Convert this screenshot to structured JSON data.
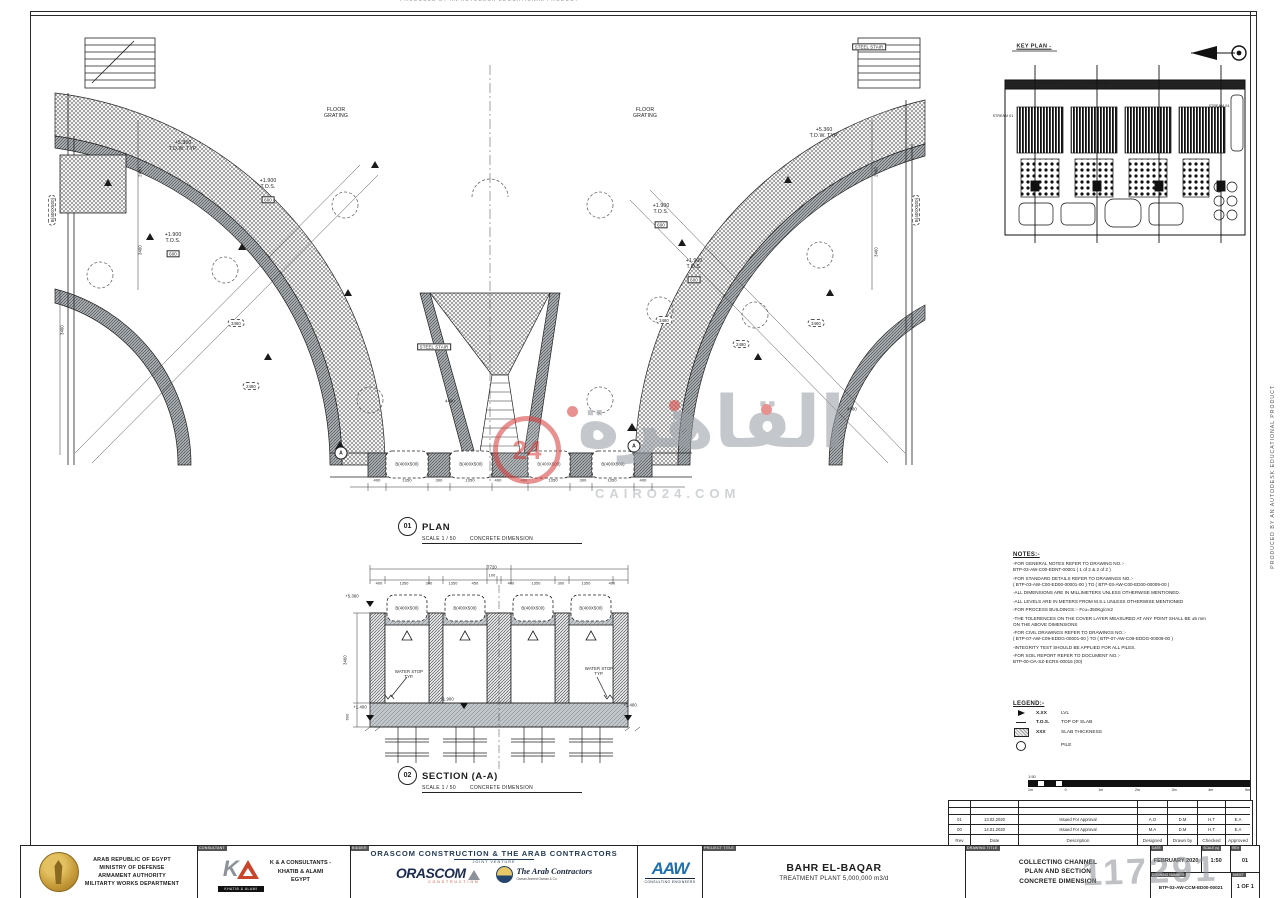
{
  "watermark": {
    "arabic": "القاهرة",
    "number": "24",
    "site": "CAIRO24.COM",
    "id": "117291"
  },
  "edge": {
    "produced": "PRODUCED BY AN AUTODESK EDUCATIONAL PRODUCT"
  },
  "plan_title": {
    "num": "01",
    "title": "PLAN",
    "scale": "SCALE 1 / 50",
    "note": "CONCRETE DIMENSION"
  },
  "section_title": {
    "num": "02",
    "title": "SECTION (A-A)",
    "scale": "SCALE 1 / 50",
    "note": "CONCRETE DIMENSION"
  },
  "notes": {
    "title": "NOTES:-",
    "items": [
      "-FOR GENERAL NOTES REFER TO DRAWING NO.:-\nBTP-03-AW-C00-EDNT-00001 ( 1 of 2 & 2 of 2 )",
      "-FOR STANDARD DETAILS REFER TO DRAWINGS NO.:-\n( BTP-03-AW-C00-ED00-00001-00 ) TO ( BTP-03-AW-C00-ED00-00009-00 )",
      "-ALL DIMENSIONS ARE IN MILLIMETERS UNLESS OTHERWISE MENTIONED.",
      "-ALL LEVELS ARE IN METERS FROM M.S.L UNLESS OTHERWISE MENTIONED",
      "-FOR PROCESS BUILDINGS :- Fcu=350Kg/cm2",
      "-THE TOLERENCES ON THE COVER LAYER MEASURED AT ANY POINT SHALL BE ±5 mm\nON THE ABOVE DIMENSIONS",
      "-FOR CIVIL DRAWINGS REFER TO DRAWINGS NO.:-\n( BTP-07-AW-C09-EDDG-00001-00 ) TO ( BTP-07-AW-C09-EDDG-00009-00 )",
      "-INTEGRITY TEST SHOULD BE APPLIED FOR ALL PILES.",
      "-FOR SOIL REPORT REFER TO DOCUMENT NO.:-\nBTP-00-OA-SZ-ECRS-00016 (00)"
    ]
  },
  "legend": {
    "title": "LEGEND:-",
    "items": [
      {
        "sym": "lvl",
        "val": "X.XX",
        "label": "LVL"
      },
      {
        "sym": "tos",
        "val": "T.O.S.",
        "label": "TOP OF SLAB"
      },
      {
        "sym": "thk",
        "val": "XXX",
        "label": "SLAB THICKNESS"
      },
      {
        "sym": "pile",
        "val": "",
        "label": "PILE"
      }
    ]
  },
  "scale_bar": {
    "ratio": "1:50",
    "ticks": [
      "1m",
      "0",
      "1m",
      "2m",
      "3m",
      "4m",
      "5m"
    ]
  },
  "revision_table": {
    "headers": [
      "Rev",
      "Date",
      "Description",
      "Designed",
      "Drawn by",
      "Checked",
      "Approved"
    ],
    "rows": [
      [
        "01",
        "13.02.2020",
        "Issued For Approval",
        "A.O",
        "D.M",
        "H.T",
        "E.A"
      ],
      [
        "00",
        "14.01.2020",
        "Issued For Approval",
        "M.A",
        "D.M",
        "H.T",
        "E.A"
      ]
    ]
  },
  "title_block": {
    "owner": {
      "lines": [
        "ARAB REPUBLIC OF EGYPT",
        "MINISTRY OF DEFENSE",
        "ARMAMENT AUTHORITY",
        "MILITARTY WORKS DEPARTMENT"
      ]
    },
    "consultant": {
      "label": "CONSULTANT",
      "logo_text": "KHATIB & ALAMI",
      "lines": [
        "K & A CONSULTANTS -",
        "KHATIB & ALAMI",
        "EGYPT"
      ]
    },
    "bidder": {
      "label": "BIDDER",
      "jv_title": "ORASCOM CONSTRUCTION & THE ARAB CONTRACTORS",
      "jv_sub": "JOINT VENTURE",
      "orascom": "ORASCOM",
      "orascom_sub": "CONSTRUCTION",
      "arab": "The Arab Contractors",
      "arab_sub": "Osman Ahmed Osman & Co.",
      "aaw": "AAW",
      "aaw_sub": "CONSULTING ENGINEERS"
    },
    "project": {
      "label": "PROJECT TITLE",
      "line1": "BAHR EL-BAQAR",
      "line2": "TREATMENT PLANT 5,000,000 m3/d"
    },
    "drawing": {
      "label": "DRAWING TITLE",
      "lines": [
        "COLLECTING CHANNEL",
        "PLAN AND SECTION",
        "CONCRETE DIMENSION"
      ]
    },
    "meta": {
      "date_label": "DATE",
      "date": "FEBRUARY 2020",
      "scale_label": "SCALE (s)",
      "scale": "1:50",
      "rev_label": "REV",
      "rev": "01",
      "num_label": "DRAWING NUMBER",
      "number": "BTP-03-AW-CCM-ED00-00021",
      "sheet_label": "SHEET",
      "sheet": "1 OF 1"
    }
  },
  "labels": [
    {
      "t": "FLOOR\nGRATING",
      "x": 336,
      "y": 113,
      "n": "floor-grating-label"
    },
    {
      "t": "FLOOR\nGRATING",
      "x": 645,
      "y": 113,
      "n": "floor-grating-label"
    },
    {
      "t": "+5.360\nT.O.W. TYP.",
      "x": 183,
      "y": 146,
      "n": "level-label"
    },
    {
      "t": "+5.360\nT.O.W. TYP.",
      "x": 824,
      "y": 133,
      "n": "level-label"
    },
    {
      "t": "+1.900\nT.O.S.",
      "x": 268,
      "y": 184,
      "n": "level-label"
    },
    {
      "t": "600",
      "x": 268,
      "y": 200,
      "cls": "box",
      "fs": 4.5,
      "n": "slab-thickness-label"
    },
    {
      "t": "+1.900\nT.O.S.",
      "x": 173,
      "y": 238,
      "n": "level-label"
    },
    {
      "t": "600",
      "x": 173,
      "y": 254,
      "cls": "box",
      "fs": 4.5,
      "n": "slab-thickness-label"
    },
    {
      "t": "+1.900\nT.O.S.",
      "x": 661,
      "y": 209,
      "n": "level-label"
    },
    {
      "t": "600",
      "x": 661,
      "y": 225,
      "cls": "box",
      "fs": 4.5,
      "n": "slab-thickness-label"
    },
    {
      "t": "+1.900\nT.O.S.",
      "x": 694,
      "y": 264,
      "n": "level-label"
    },
    {
      "t": "600",
      "x": 694,
      "y": 280,
      "cls": "box",
      "fs": 4.5,
      "n": "slab-thickness-label"
    },
    {
      "t": "B(400X500)",
      "x": 52,
      "y": 210,
      "rot": -90,
      "fs": 4.4,
      "cls": "cloud",
      "n": "beam-label"
    },
    {
      "t": "B(400X500)",
      "x": 916,
      "y": 210,
      "rot": -90,
      "fs": 4.4,
      "cls": "cloud",
      "n": "beam-label"
    },
    {
      "t": "STEEL STAIR",
      "x": 869,
      "y": 47,
      "cls": "box",
      "fs": 4.4,
      "n": "steel-stair-label"
    },
    {
      "t": "STEEL STAIR",
      "x": 434,
      "y": 347,
      "cls": "box",
      "fs": 4.4,
      "n": "steel-stair-label"
    },
    {
      "t": "B(400X500)",
      "x": 407,
      "y": 464,
      "fs": 4.2,
      "n": "beam-label"
    },
    {
      "t": "B(400X500)",
      "x": 471,
      "y": 464,
      "fs": 4.2,
      "n": "beam-label"
    },
    {
      "t": "B(400X500)",
      "x": 549,
      "y": 464,
      "fs": 4.2,
      "n": "beam-label"
    },
    {
      "t": "B(400X500)",
      "x": 613,
      "y": 464,
      "fs": 4.2,
      "n": "beam-label"
    },
    {
      "t": "400",
      "x": 377,
      "y": 481,
      "fs": 4,
      "n": "dimension"
    },
    {
      "t": "1350",
      "x": 407,
      "y": 481,
      "fs": 4,
      "n": "dimension"
    },
    {
      "t": "300",
      "x": 439,
      "y": 481,
      "fs": 4,
      "n": "dimension"
    },
    {
      "t": "1350",
      "x": 470,
      "y": 481,
      "fs": 4,
      "n": "dimension"
    },
    {
      "t": "400",
      "x": 498,
      "y": 481,
      "fs": 4,
      "n": "dimension"
    },
    {
      "t": "400",
      "x": 524,
      "y": 481,
      "fs": 4,
      "n": "dimension"
    },
    {
      "t": "1350",
      "x": 553,
      "y": 481,
      "fs": 4,
      "n": "dimension"
    },
    {
      "t": "300",
      "x": 583,
      "y": 481,
      "fs": 4,
      "n": "dimension"
    },
    {
      "t": "1350",
      "x": 612,
      "y": 481,
      "fs": 4,
      "n": "dimension"
    },
    {
      "t": "400",
      "x": 643,
      "y": 481,
      "fs": 4,
      "n": "dimension"
    },
    {
      "t": "2480",
      "x": 140,
      "y": 172,
      "rot": -90,
      "fs": 4.2,
      "n": "dimension"
    },
    {
      "t": "3460",
      "x": 140,
      "y": 250,
      "rot": -90,
      "fs": 4.2,
      "n": "dimension"
    },
    {
      "t": "3460",
      "x": 62,
      "y": 330,
      "rot": -90,
      "fs": 4.2,
      "n": "dimension"
    },
    {
      "t": "2480",
      "x": 876,
      "y": 172,
      "rot": -90,
      "fs": 4.2,
      "n": "dimension"
    },
    {
      "t": "3460",
      "x": 876,
      "y": 252,
      "rot": -90,
      "fs": 4.2,
      "n": "dimension"
    },
    {
      "t": "4480",
      "x": 450,
      "y": 401,
      "fs": 4.2,
      "n": "dimension"
    },
    {
      "t": "4480",
      "x": 852,
      "y": 409,
      "fs": 4.2,
      "n": "dimension"
    },
    {
      "t": "3460",
      "x": 236,
      "y": 323,
      "cls": "cloud",
      "fs": 4.2,
      "n": "dimension"
    },
    {
      "t": "2480",
      "x": 251,
      "y": 386,
      "cls": "cloud",
      "fs": 4.2,
      "n": "dimension"
    },
    {
      "t": "3460",
      "x": 664,
      "y": 320,
      "cls": "cloud",
      "fs": 4.2,
      "n": "dimension"
    },
    {
      "t": "3460",
      "x": 816,
      "y": 323,
      "cls": "cloud",
      "fs": 4.2,
      "n": "dimension"
    },
    {
      "t": "2480",
      "x": 741,
      "y": 344,
      "cls": "cloud",
      "fs": 4.2,
      "n": "dimension"
    },
    {
      "t": "A",
      "x": 341,
      "y": 453,
      "cls": "amark",
      "fs": 5,
      "n": "section-cut-marker"
    },
    {
      "t": "A",
      "x": 634,
      "y": 446,
      "cls": "amark",
      "fs": 5,
      "n": "section-cut-marker"
    },
    {
      "t": "7720",
      "x": 492,
      "y": 567,
      "fs": 4.2,
      "n": "dimension"
    },
    {
      "t": "100",
      "x": 492,
      "y": 576,
      "fs": 3.8,
      "n": "dimension"
    },
    {
      "t": "400",
      "x": 379,
      "y": 584,
      "fs": 3.8,
      "n": "dimension"
    },
    {
      "t": "1350",
      "x": 404,
      "y": 584,
      "fs": 3.8,
      "n": "dimension"
    },
    {
      "t": "300",
      "x": 429,
      "y": 584,
      "fs": 3.8,
      "n": "dimension"
    },
    {
      "t": "1350",
      "x": 453,
      "y": 584,
      "fs": 3.8,
      "n": "dimension"
    },
    {
      "t": "450",
      "x": 475,
      "y": 584,
      "fs": 3.8,
      "n": "dimension"
    },
    {
      "t": "400",
      "x": 511,
      "y": 584,
      "fs": 3.8,
      "n": "dimension"
    },
    {
      "t": "1350",
      "x": 536,
      "y": 584,
      "fs": 3.8,
      "n": "dimension"
    },
    {
      "t": "300",
      "x": 561,
      "y": 584,
      "fs": 3.8,
      "n": "dimension"
    },
    {
      "t": "1350",
      "x": 586,
      "y": 584,
      "fs": 3.8,
      "n": "dimension"
    },
    {
      "t": "400",
      "x": 612,
      "y": 584,
      "fs": 3.8,
      "n": "dimension"
    },
    {
      "t": "+5.360",
      "x": 352,
      "y": 596,
      "fs": 4.2,
      "n": "level-label"
    },
    {
      "t": "3460",
      "x": 345,
      "y": 660,
      "rot": -90,
      "fs": 4.2,
      "n": "dimension"
    },
    {
      "t": "600",
      "x": 348,
      "y": 717,
      "rot": -90,
      "fs": 3.8,
      "n": "dimension"
    },
    {
      "t": "+1.400",
      "x": 360,
      "y": 707,
      "fs": 4.2,
      "n": "level-label"
    },
    {
      "t": "+1.400",
      "x": 630,
      "y": 705,
      "fs": 4.2,
      "n": "level-label"
    },
    {
      "t": "+1.900",
      "x": 447,
      "y": 699,
      "fs": 4.2,
      "n": "level-label"
    },
    {
      "t": "WATER STOP\nTYP.",
      "x": 409,
      "y": 674,
      "fs": 4.2,
      "n": "water-stop-label"
    },
    {
      "t": "WATER STOP\nTYP.",
      "x": 599,
      "y": 671,
      "fs": 4.2,
      "n": "water-stop-label"
    },
    {
      "t": "B(400X500)",
      "x": 407,
      "y": 608,
      "fs": 4.2,
      "n": "beam-label"
    },
    {
      "t": "B(400X500)",
      "x": 465,
      "y": 608,
      "fs": 4.2,
      "n": "beam-label"
    },
    {
      "t": "B(400X500)",
      "x": 533,
      "y": 608,
      "fs": 4.2,
      "n": "beam-label"
    },
    {
      "t": "B(400X500)",
      "x": 591,
      "y": 608,
      "fs": 4.2,
      "n": "beam-label"
    },
    {
      "t": "KEY PLAN -",
      "x": 1034,
      "y": 47,
      "fs": 5.5,
      "cls": "underline",
      "n": "key-plan-title"
    },
    {
      "t": "STREAM 01",
      "x": 1003,
      "y": 116,
      "fs": 3.6,
      "n": "stream-01-label"
    },
    {
      "t": "STREAM 02",
      "x": 1049,
      "y": 83,
      "fs": 3.6,
      "n": "stream-02-label"
    },
    {
      "t": "STREAM 03",
      "x": 1097,
      "y": 83,
      "fs": 3.6,
      "n": "stream-03-label"
    },
    {
      "t": "STREAM 04",
      "x": 1219,
      "y": 106,
      "fs": 3.6,
      "n": "stream-04-label"
    }
  ]
}
